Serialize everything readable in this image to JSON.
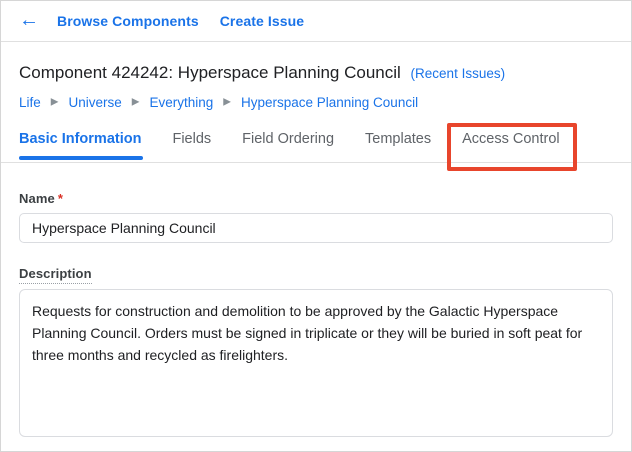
{
  "icons": {
    "back_arrow": "←",
    "breadcrumb_separator": "▶"
  },
  "topbar": {
    "browse_components_label": "Browse Components",
    "create_issue_label": "Create Issue"
  },
  "header": {
    "title": "Component 424242: Hyperspace Planning Council",
    "recent_issues_label": "(Recent Issues)"
  },
  "breadcrumb": {
    "items": [
      "Life",
      "Universe",
      "Everything",
      "Hyperspace Planning Council"
    ]
  },
  "tabs": {
    "basic_information": "Basic Information",
    "fields": "Fields",
    "field_ordering": "Field Ordering",
    "templates": "Templates",
    "access_control": "Access Control",
    "active_tab": "Basic Information",
    "annotated_tab": "Access Control"
  },
  "form": {
    "name": {
      "label": "Name",
      "required_marker": "*",
      "value": "Hyperspace Planning Council"
    },
    "description": {
      "label": "Description",
      "value": "Requests for construction and demolition to be approved by the Galactic Hyperspace Planning Council. Orders must be signed in triplicate or they will be buried in soft peat for three months and recycled as firelighters."
    }
  },
  "colors": {
    "link_blue": "#1a73e8",
    "active_tab_blue": "#1a73e8",
    "annotation_red": "#e8452c",
    "required_asterisk_red": "#d93025",
    "text_dark": "#202124",
    "text_gray": "#5f6368",
    "border_gray": "#dadce0"
  }
}
